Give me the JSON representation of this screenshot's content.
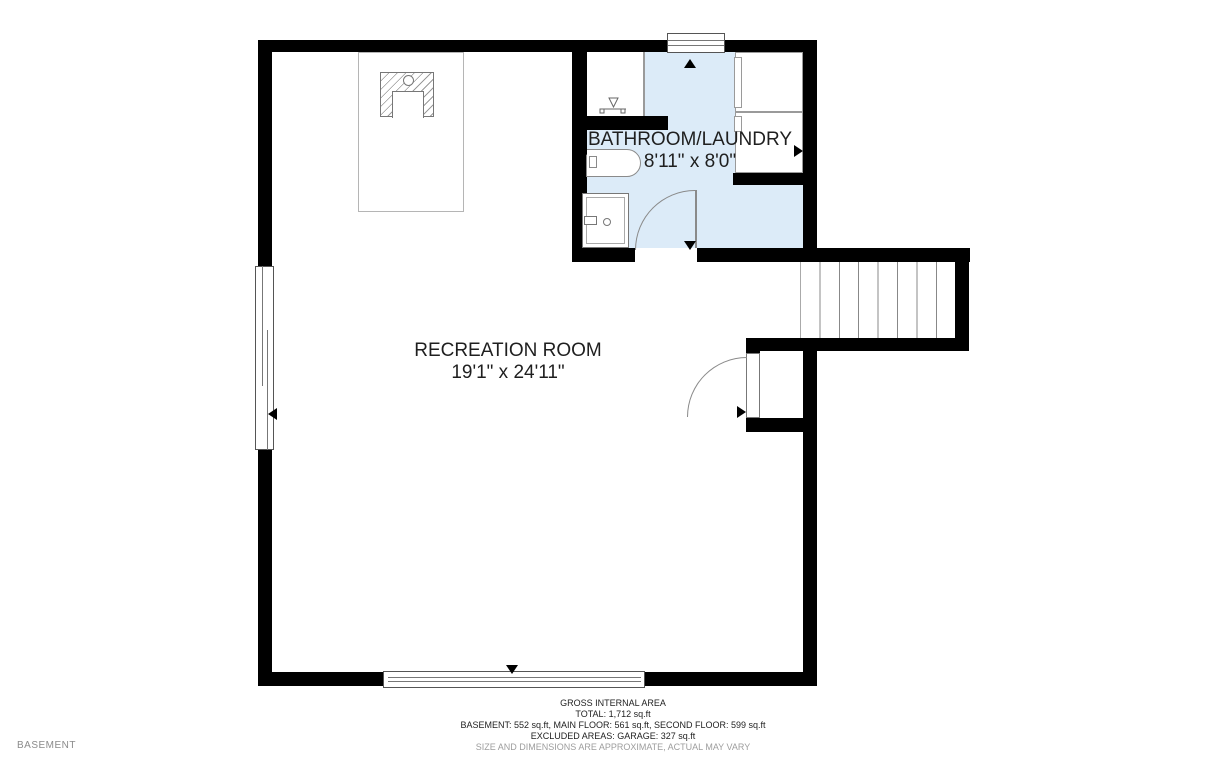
{
  "level_label": "BASEMENT",
  "rooms": [
    {
      "name": "BATHROOM/LAUNDRY",
      "dims": "8'11\" x 8'0\""
    },
    {
      "name": "RECREATION ROOM",
      "dims": "19'1\" x 24'11\""
    }
  ],
  "footer": {
    "line1": "GROSS INTERNAL AREA",
    "line2": "TOTAL: 1,712 sq.ft",
    "line3": "BASEMENT: 552 sq.ft, MAIN FLOOR: 561 sq.ft, SECOND FLOOR: 599 sq.ft",
    "line4": "EXCLUDED AREAS: GARAGE: 327 sq.ft",
    "line5": "SIZE AND DIMENSIONS ARE APPROXIMATE, ACTUAL MAY VARY"
  },
  "icons": {
    "door_swing": "quarter-arc",
    "window_marker": "black-triangle",
    "dimension_marker": "black-triangle",
    "stairs": "parallel-treads",
    "fireplace": "hatched-box"
  },
  "colors": {
    "wall": "#000000",
    "room_fill": "#dcebf8",
    "line": "#8a8a8a",
    "text": "#1f1f1f",
    "muted": "#9d9d9d"
  }
}
